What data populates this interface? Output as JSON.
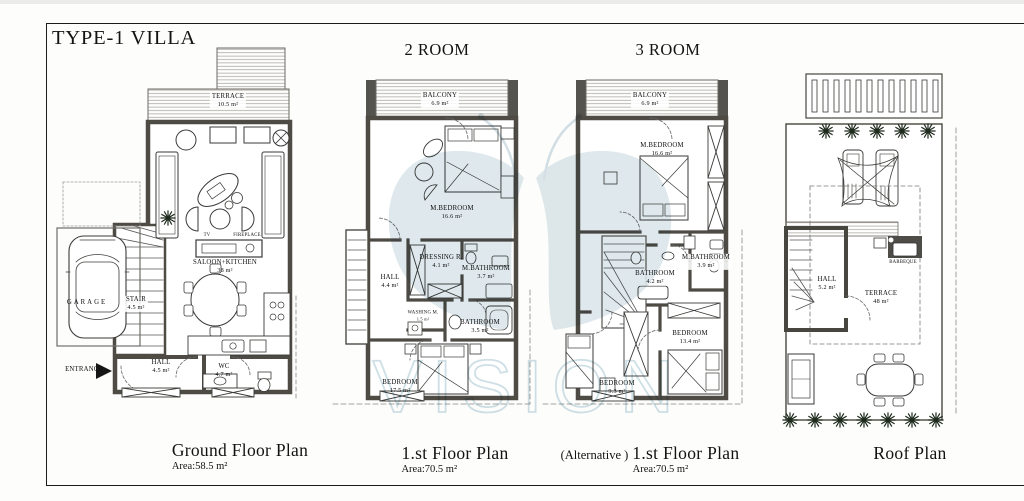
{
  "page": {
    "title": "TYPE-1 VILLA"
  },
  "column_headers": {
    "two_room": "2 ROOM",
    "three_room": "3 ROOM"
  },
  "watermark": {
    "text": "VISION",
    "color": "#b5cbd6"
  },
  "plans": [
    {
      "id": "ground-floor",
      "caption": "Ground Floor Plan",
      "area_note": "Area:58.5 m²",
      "labels": [
        {
          "text": "TERRACE",
          "area": "10.5 m²",
          "x": 228,
          "y": 101,
          "bg": true
        },
        {
          "text": "SALOON+KITCHEN",
          "area": "38 m²",
          "x": 225,
          "y": 267
        },
        {
          "text": "TV",
          "x": 207,
          "y": 236,
          "size": "xs"
        },
        {
          "text": "FIREPLACE",
          "x": 247,
          "y": 236,
          "size": "xs"
        },
        {
          "text": "GARAGE",
          "x": 87,
          "y": 303,
          "ls": 2
        },
        {
          "text": "STAIR",
          "area": "4.5 m²",
          "x": 136,
          "y": 304,
          "bg": true
        },
        {
          "text": "ENTRANCE",
          "x": 84,
          "y": 370
        },
        {
          "text": "HALL",
          "area": "4.5 m²",
          "x": 161,
          "y": 367
        },
        {
          "text": "WC",
          "area": "4.7 m²",
          "x": 224,
          "y": 371
        }
      ]
    },
    {
      "id": "first-floor",
      "caption": "1.st Floor Plan",
      "area_note": "Area:70.5 m²",
      "labels": [
        {
          "text": "BALCONY",
          "area": "6.9 m²",
          "x": 440,
          "y": 100,
          "bg": true
        },
        {
          "text": "M.BEDROOM",
          "area": "16.6 m²",
          "x": 452,
          "y": 213
        },
        {
          "text": "DRESSING R.",
          "area": "4.1 m²",
          "x": 441,
          "y": 262
        },
        {
          "text": "M.BATHROOM",
          "area": "3.7 m²",
          "x": 486,
          "y": 273
        },
        {
          "text": "HALL",
          "area": "4.4 m²",
          "x": 390,
          "y": 282
        },
        {
          "text": "WASHING M.",
          "area": "1.5 m²",
          "x": 423,
          "y": 316,
          "size": "xs",
          "bg": true
        },
        {
          "text": "BATHROOM",
          "area": "3.5 m²",
          "x": 480,
          "y": 327
        },
        {
          "text": "BEDROOM",
          "area": "17.5 m²",
          "x": 400,
          "y": 387
        }
      ]
    },
    {
      "id": "first-floor-alternative",
      "caption_prefix": "(Alternative )",
      "caption": "1.st Floor Plan",
      "area_note": "Area:70.5 m²",
      "labels": [
        {
          "text": "BALCONY",
          "area": "6.9 m²",
          "x": 650,
          "y": 100,
          "bg": true
        },
        {
          "text": "M.BEDROOM",
          "area": "16.6 m²",
          "x": 662,
          "y": 150
        },
        {
          "text": "M.BATHROOM",
          "area": "3.9 m²",
          "x": 706,
          "y": 262,
          "bg": true
        },
        {
          "text": "BATHROOM",
          "area": "4.2 m²",
          "x": 655,
          "y": 278,
          "bg": true
        },
        {
          "text": "BEDROOM",
          "area": "13.4 m²",
          "x": 690,
          "y": 338
        },
        {
          "text": "BEDROOM",
          "area": "9.3 m²",
          "x": 617,
          "y": 388
        }
      ]
    },
    {
      "id": "roof",
      "caption": "Roof Plan",
      "labels": [
        {
          "text": "HALL",
          "area": "5.2 m²",
          "x": 827,
          "y": 284
        },
        {
          "text": "TERRACE",
          "area": "48 m²",
          "x": 881,
          "y": 298
        },
        {
          "text": "BARBEQUE",
          "x": 903,
          "y": 263,
          "size": "xs",
          "bg": true
        }
      ]
    }
  ]
}
